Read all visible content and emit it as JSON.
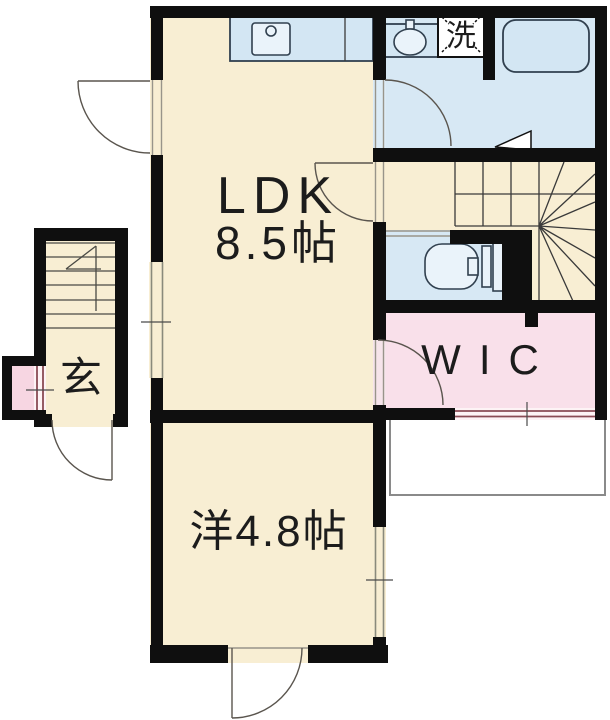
{
  "plan": {
    "type": "apartment-floor-plan",
    "labels": {
      "ldk": "LDK",
      "ldk_size": "8.5帖",
      "western_room": "洋4.8帖",
      "wic": "WIC",
      "entrance": "玄",
      "laundry": "洗"
    },
    "colors": {
      "room_cream": "#F8EED3",
      "wet_blue": "#D7E8F4",
      "closet_pink": "#F9E0EA",
      "nook_pink": "#F7D6E2",
      "hall_cream": "#F8EED3",
      "wall_black": "#0F0F0F",
      "fixture_blue": "#EAF3FA",
      "window_maroon": "#8A4B55"
    }
  }
}
